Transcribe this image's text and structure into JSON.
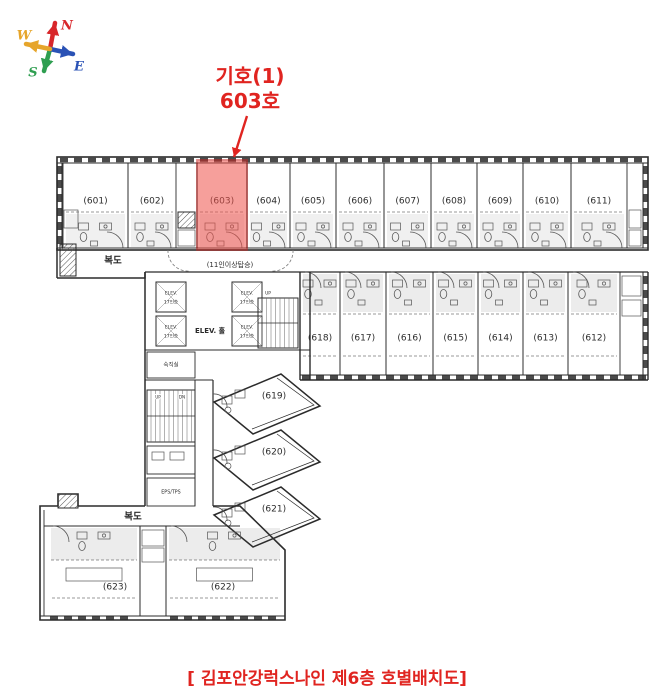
{
  "compass": {
    "north": "N",
    "south": "S",
    "east": "E",
    "west": "W"
  },
  "annotation": {
    "line1": "기호(1)",
    "line2": "603호"
  },
  "caption": {
    "text": "[ 김포안강럭스나인 제6층 호별배치도]"
  },
  "colors": {
    "annotation_red": "#e02420",
    "highlight_fill": "#f0524b",
    "highlight_stroke": "#c62420",
    "plan_line": "#2b2b2b",
    "detail_line": "#555555",
    "compass_north": "#d8262a",
    "compass_south": "#2e9e50",
    "compass_east": "#2a52b5",
    "compass_west": "#e6a52b"
  },
  "floor_plan": {
    "top_rooms": [
      "(601)",
      "(602)",
      "(603)",
      "(604)",
      "(605)",
      "(606)",
      "(607)",
      "(608)",
      "(609)",
      "(610)",
      "(611)"
    ],
    "mid_rooms": [
      "(618)",
      "(617)",
      "(616)",
      "(615)",
      "(614)",
      "(613)",
      "(612)"
    ],
    "diagonal_rooms": [
      "(619)",
      "(620)",
      "(621)"
    ],
    "bottom_rooms": [
      "(623)",
      "(622)"
    ],
    "highlighted_room": "(603)",
    "labels": {
      "corridor_top": "복도",
      "corridor_bottom": "복도",
      "elevator_hall": "ELEV. 홀",
      "elevator_note": "(11인이상탑승)",
      "elevator_car": "ELEV.",
      "elevator_capacity": "17인승",
      "stair_up": "UP",
      "stair_down": "DN",
      "service_room": "EPS/TPS",
      "duty_room": "숙직실"
    }
  }
}
